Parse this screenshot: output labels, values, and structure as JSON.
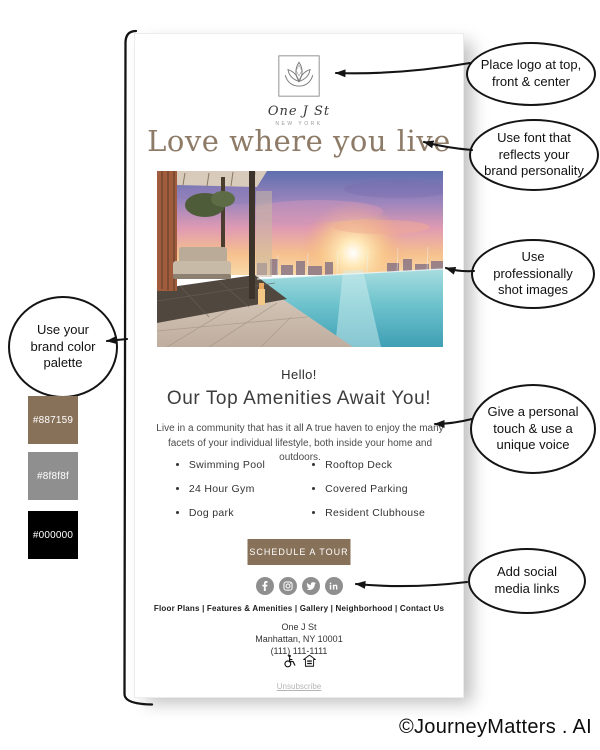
{
  "watermark": "©JourneyMatters . AI",
  "annotations": {
    "logo": "Place logo at top, front & center",
    "font": "Use font that reflects your brand personality",
    "images": "Use professionally shot images",
    "palette": "Use your brand color palette",
    "voice": "Give a personal touch & use a unique voice",
    "social": "Add social media links"
  },
  "palette": {
    "swatches": [
      {
        "hex": "#887159"
      },
      {
        "hex": "#8f8f8f"
      },
      {
        "hex": "#000000"
      }
    ]
  },
  "colors": {
    "accent": "#887159",
    "gray": "#8f8f8f",
    "black": "#000000",
    "headline_taupe": "#8d7b68"
  },
  "email": {
    "logo": {
      "brand": "One J St",
      "tagline": "NEW YORK"
    },
    "headline": "Love where you live",
    "greeting": "Hello!",
    "subheading": "Our Top Amenities Await You!",
    "body_text": "Live in a community that has it all A true haven to enjoy the many facets of your individual lifestyle, both inside your home and outdoors.",
    "amenities": {
      "left": [
        "Swimming Pool",
        "24 Hour Gym",
        "Dog park"
      ],
      "right": [
        "Rooftop Deck",
        "Covered Parking",
        "Resident Clubhouse"
      ]
    },
    "cta": "SCHEDULE A TOUR",
    "social_icons": [
      "facebook-icon",
      "instagram-icon",
      "twitter-icon",
      "linkedin-icon"
    ],
    "footer_nav": "Floor Plans | Features & Amenities | Gallery | Neighborhood | Contact Us",
    "address": {
      "line1": "One J St",
      "line2": "Manhattan, NY 10001",
      "line3": "(111) 111-1111"
    },
    "unsubscribe": "Unsubscribe"
  }
}
